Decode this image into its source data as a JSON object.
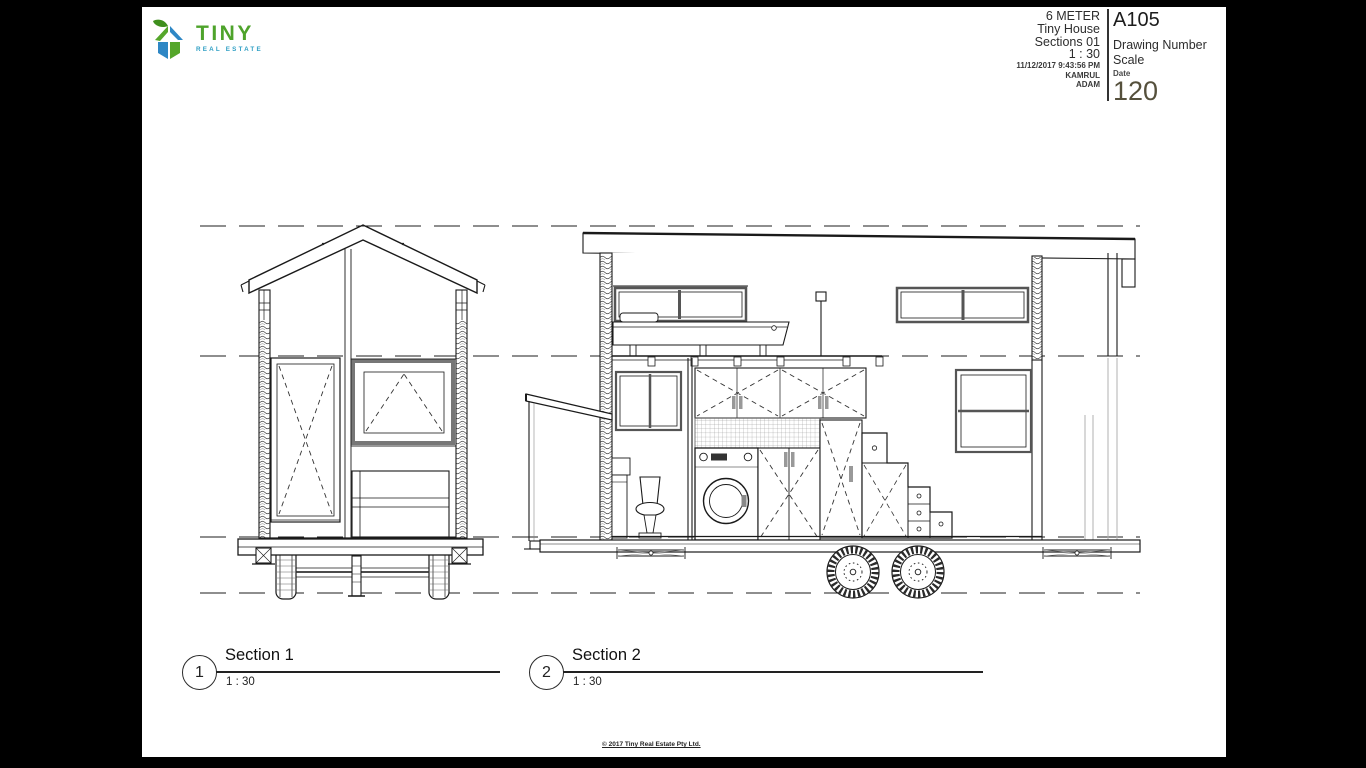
{
  "window": {
    "background": "#000000"
  },
  "sheet": {
    "background": "#ffffff"
  },
  "logo": {
    "brand": "TINY",
    "tagline": "REAL ESTATE",
    "icon": "house-with-leaf-icon",
    "colors": {
      "green": "#4ea32b",
      "blue": "#2e87c5",
      "leaf": "#3f8f1d",
      "tagline_blue": "#2f9fc4"
    }
  },
  "title_block": {
    "project_name_line1": "6 METER",
    "project_name_line2": "Tiny House",
    "sheet_name": "Sections 01",
    "scale_value": "1 : 30",
    "print_datetime": "11/12/2017 9:43:56 PM",
    "author": "KAMRUL",
    "checker": "ADAM",
    "sheet_number": "A105",
    "labels": {
      "drawing_number": "Drawing Number",
      "scale": "Scale",
      "date": "Date"
    },
    "date_value": "120",
    "date_value_color": "#55503c"
  },
  "viewports": [
    {
      "number": "1",
      "title": "Section 1",
      "scale": "1 : 30"
    },
    {
      "number": "2",
      "title": "Section 2",
      "scale": "1 : 30"
    }
  ],
  "footer": {
    "copyright": "© 2017 Tiny Real Estate Pty Ltd."
  }
}
